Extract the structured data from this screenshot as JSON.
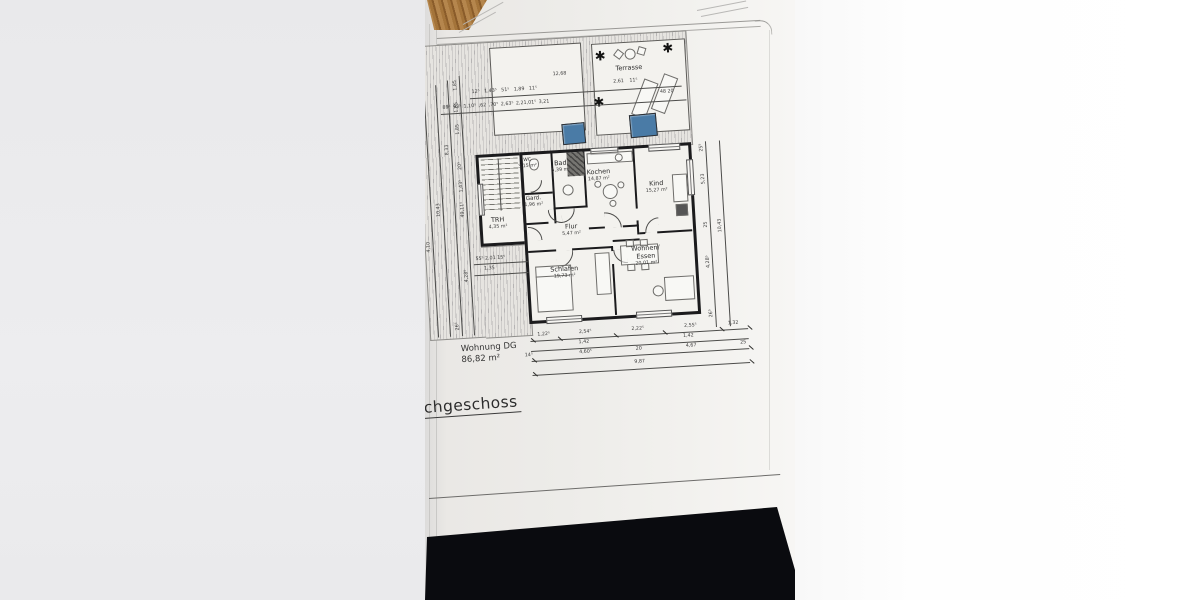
{
  "sheet": {
    "title_partial": "chgeschoss",
    "summary_label": "Wohnung DG",
    "summary_area": "86,82 m²"
  },
  "rooms": {
    "terrasse": {
      "name": "Terrasse"
    },
    "trh": {
      "name": "TRH",
      "area": "4,35 m²"
    },
    "wc": {
      "name": "WC",
      "area": "3,15 m²"
    },
    "bad": {
      "name": "Bad",
      "area": "5,39 m²"
    },
    "gard": {
      "name": "Gard.",
      "area": "1,96 m²"
    },
    "kochen": {
      "name": "Kochen",
      "area": "14,87 m²"
    },
    "kind": {
      "name": "Kind",
      "area": "15,27 m²"
    },
    "flur": {
      "name": "Flur",
      "area": "5,47 m²"
    },
    "schlafen": {
      "name": "Schlafen",
      "area": "19,73 m²"
    },
    "wohnen": {
      "name": "Wohnen/",
      "name2": "Essen",
      "area": "20,01 m²"
    }
  },
  "dimensions": {
    "top_total": "12,68",
    "top_row1_left": "12⁵ 1,43⁵ 51⁵ 1,89 11⁵",
    "top_row1_right": "2,61 11⁵",
    "top_row2": "89⁵ 93⁵ 1,10⁵ ,62 ,70⁵ 2,63⁵ 2,21,01⁵ 3,21",
    "top_right_small": "48  20",
    "bottom_row1": [
      "1,22⁵",
      "2,54⁵",
      "2,22⁵",
      "2,55⁵",
      "1,32"
    ],
    "bottom_row2_a": "1,42",
    "bottom_row2_b": "1,42",
    "bottom_row3": [
      "14⁵",
      "4,60⁵",
      "20",
      "4,67",
      "25"
    ],
    "bottom_total": "9,87",
    "mid_left_row": "55⁵  2,01  15⁵",
    "mid_left_under": "1,35",
    "left_chain": [
      "1,85",
      "1,85",
      "1,85",
      "8,33",
      "10,43",
      "20⁵",
      "1,43⁵",
      "49,11⁵",
      "4,28⁵",
      "4,10",
      "26⁵"
    ],
    "right_chain": [
      "25⁵",
      "5,23",
      "25",
      "4,28⁵",
      "26⁵",
      "10,43"
    ]
  },
  "colors": {
    "skylight": "#4a7ba6",
    "wall": "#1b1b1d",
    "wood_table": "#a4743a",
    "dark_table": "#0a0b0f"
  },
  "icons": {
    "plant": "✱"
  }
}
